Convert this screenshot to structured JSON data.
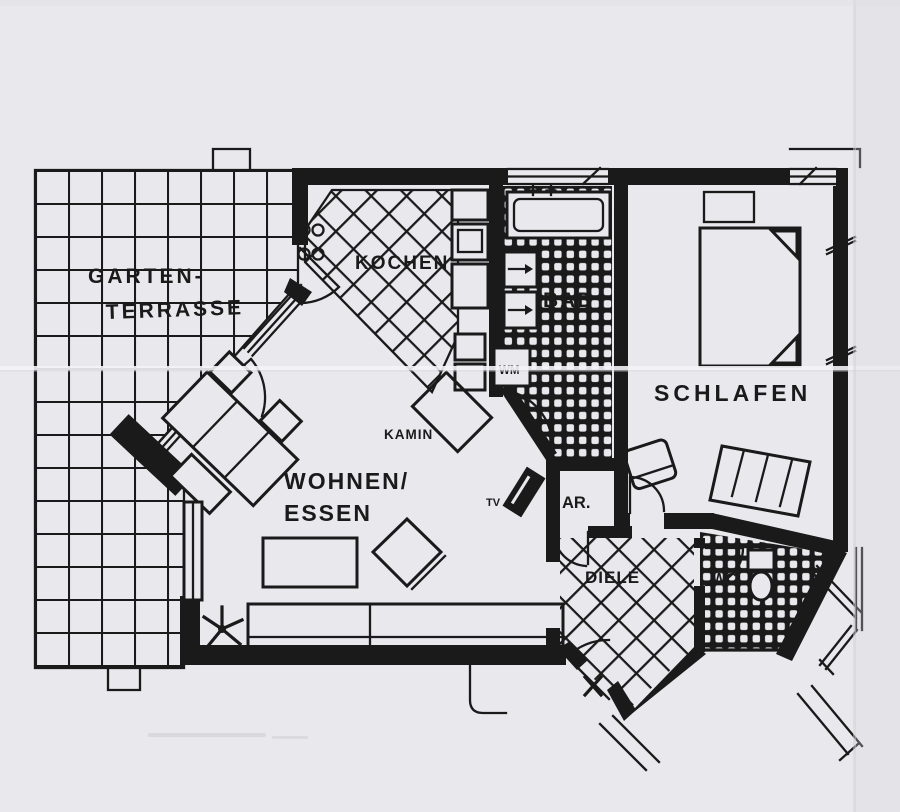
{
  "colors": {
    "ink": "#1a1a1a",
    "paper": "#e9e9ed",
    "paper_shadow": "#d7d7dc"
  },
  "rooms": {
    "terrace": {
      "label_line1": "GARTEN-",
      "label_line2": "TERRASSE"
    },
    "kitchen": {
      "label": "KOCHEN"
    },
    "bath": {
      "label": "BAD"
    },
    "bedroom": {
      "label": "SCHLAFEN"
    },
    "living": {
      "label_line1": "WOHNEN/",
      "label_line2": "ESSEN"
    },
    "storage": {
      "label": "AR."
    },
    "hall": {
      "label": "DIELE"
    },
    "wc": {
      "label": "WC"
    }
  },
  "annotations": {
    "fireplace": "KAMIN",
    "washing_machine": "WM",
    "tv": "TV"
  }
}
